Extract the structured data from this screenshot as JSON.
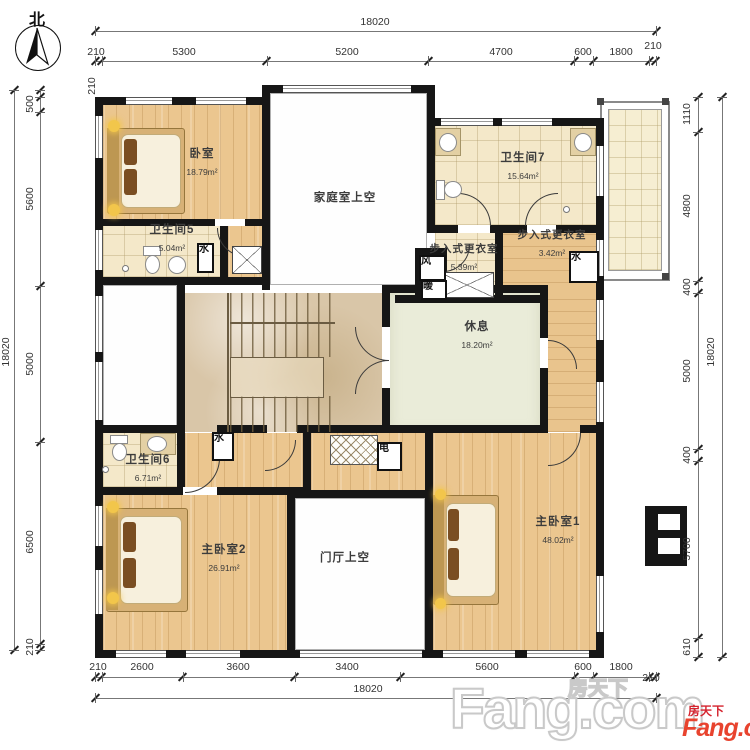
{
  "compass": {
    "label": "北"
  },
  "dims": {
    "overall": "18020",
    "top": [
      "210",
      "5300",
      "5200",
      "4700",
      "600",
      "1800",
      "210"
    ],
    "bottom": [
      "210",
      "2600",
      "3600",
      "3400",
      "5600",
      "600",
      "1800",
      "210"
    ],
    "left": [
      "210",
      "500",
      "5600",
      "5000",
      "6500",
      "210"
    ],
    "right": [
      "1110",
      "4800",
      "400",
      "5000",
      "400",
      "5700",
      "610"
    ]
  },
  "rooms": {
    "bedroom": {
      "name": "卧室",
      "area": "18.79m²"
    },
    "bath5": {
      "name": "卫生间5",
      "area": "5.04m²"
    },
    "family_void": {
      "name": "家庭室上空"
    },
    "bath7": {
      "name": "卫生间7",
      "area": "15.64m²"
    },
    "closet_a": {
      "name": "步入式更衣室",
      "area": "5.39m²"
    },
    "closet_b": {
      "name": "步入式更衣室",
      "area": "3.42m²"
    },
    "rest": {
      "name": "休息",
      "area": "18.20m²"
    },
    "bath6": {
      "name": "卫生间6",
      "area": "6.71m²"
    },
    "master2": {
      "name": "主卧室2",
      "area": "26.91m²"
    },
    "foyer_void": {
      "name": "门厅上空"
    },
    "master1": {
      "name": "主卧室1",
      "area": "48.02m²"
    }
  },
  "shafts": {
    "water": "水",
    "wind": "风",
    "heat": "暖",
    "elec": "电"
  },
  "watermark": {
    "cn": "房天下",
    "en": "Fang.com"
  },
  "logo": {
    "cn": "房天下",
    "en": "Fang.com",
    "color": "#e8432e"
  },
  "colors": {
    "wall": "#161616",
    "wood": "#ebc68f",
    "tile": "#f4e8c9",
    "rest": "#eaecd9",
    "marble": "#d9c6a8"
  }
}
